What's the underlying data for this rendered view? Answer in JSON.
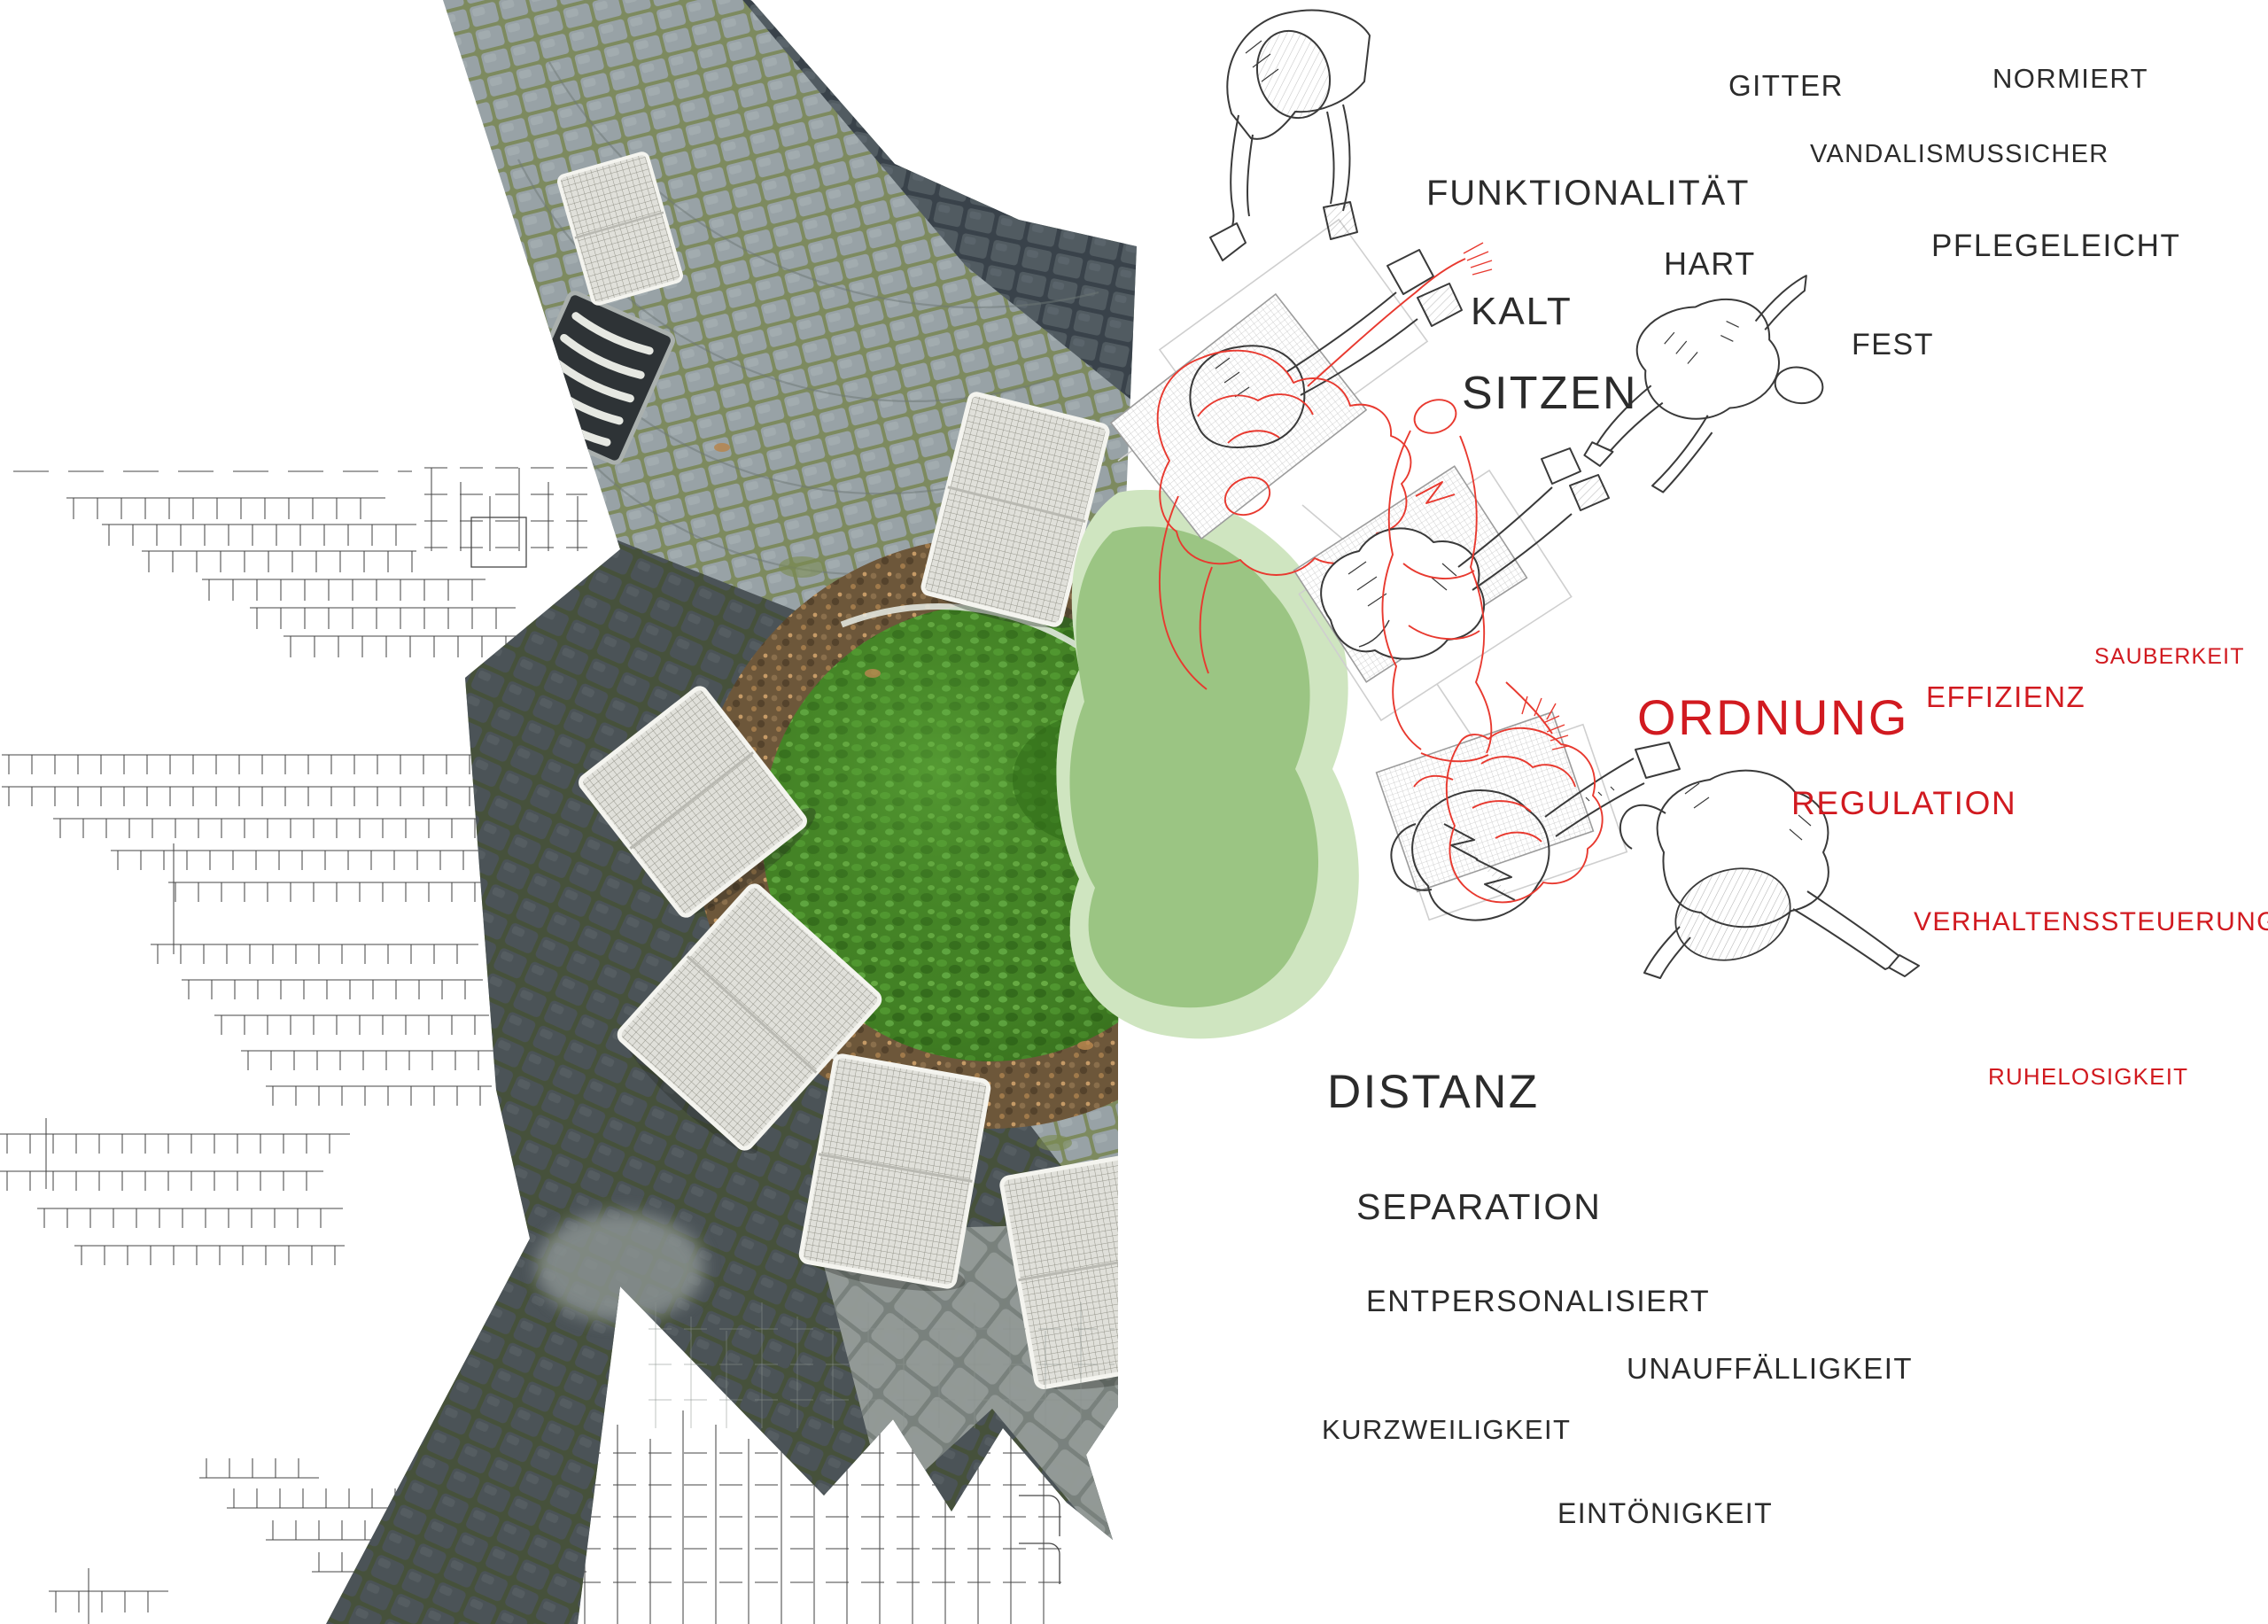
{
  "palette": {
    "black_text": "#2b2b2b",
    "red_text": "#d11a20",
    "red_line": "#e8392f",
    "line_grey": "#474747",
    "blob_light": "#cfe5c0",
    "blob_mid": "#9bc583",
    "bush_green": "#4a8f2c",
    "earth_brown": "#6d573a",
    "cobble_light": "#98a2a6",
    "cobble_dark": "#4b5357"
  },
  "words": [
    {
      "id": "gitter",
      "label": "GITTER",
      "tone": "black"
    },
    {
      "id": "normiert",
      "label": "NORMIERT",
      "tone": "black"
    },
    {
      "id": "funktionalitaet",
      "label": "FUNKTIONALITÄT",
      "tone": "black"
    },
    {
      "id": "vandalismussicher",
      "label": "VANDALISMUSSICHER",
      "tone": "black"
    },
    {
      "id": "hart",
      "label": "HART",
      "tone": "black"
    },
    {
      "id": "kalt",
      "label": "KALT",
      "tone": "black"
    },
    {
      "id": "pflegeleicht",
      "label": "PFLEGELEICHT",
      "tone": "black"
    },
    {
      "id": "fest",
      "label": "FEST",
      "tone": "black"
    },
    {
      "id": "sitzen",
      "label": "SITZEN",
      "tone": "black"
    },
    {
      "id": "sauberkeit",
      "label": "SAUBERKEIT",
      "tone": "red"
    },
    {
      "id": "effizienz",
      "label": "EFFIZIENZ",
      "tone": "red"
    },
    {
      "id": "ordnung",
      "label": "ORDNUNG",
      "tone": "red"
    },
    {
      "id": "regulation",
      "label": "REGULATION",
      "tone": "red"
    },
    {
      "id": "verhaltenssteuerung",
      "label": "VERHALTENSSTEUERUNG",
      "tone": "red"
    },
    {
      "id": "ruhelosigkeit",
      "label": "RUHELOSIGKEIT",
      "tone": "red"
    },
    {
      "id": "distanz",
      "label": "DISTANZ",
      "tone": "black"
    },
    {
      "id": "separation",
      "label": "SEPARATION",
      "tone": "black"
    },
    {
      "id": "entpersonalisiert",
      "label": "ENTPERSONALISIERT",
      "tone": "black"
    },
    {
      "id": "unauffaelligkeit",
      "label": "UNAUFFÄLLIGKEIT",
      "tone": "black"
    },
    {
      "id": "kurzweiligkeit",
      "label": "KURZWEILIGKEIT",
      "tone": "black"
    },
    {
      "id": "eintoenigkeit",
      "label": "EINTÖNIGKEIT",
      "tone": "black"
    }
  ]
}
